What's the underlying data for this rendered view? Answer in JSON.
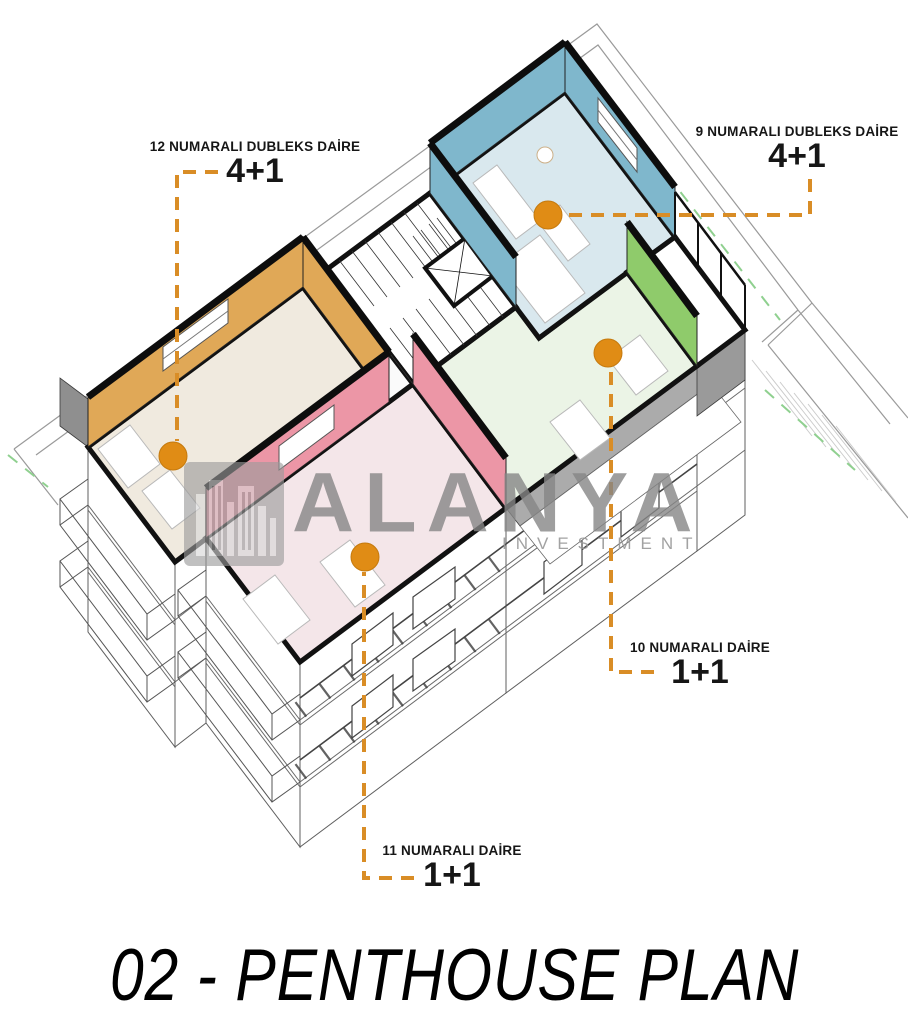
{
  "page": {
    "background": "#ffffff"
  },
  "drawing": {
    "marker_color": "#E08C15",
    "leader_color": "#D98D26",
    "setback_line_color": "#8FD08F",
    "cut_wall_color": "#111111"
  },
  "units": [
    {
      "number": "9",
      "label": "9 NUMARALI DUBLEKS DAİRE",
      "type": "4+1",
      "wall_color": "#7FB7CC",
      "floor_color": "#D9E8EE"
    },
    {
      "number": "10",
      "label": "10 NUMARALI DAİRE",
      "type": "1+1",
      "wall_color": "#8FCB6B",
      "floor_color": "#EBF4E6"
    },
    {
      "number": "11",
      "label": "11 NUMARALI DAİRE",
      "type": "1+1",
      "wall_color": "#EC96A6",
      "floor_color": "#F4E6E9"
    },
    {
      "number": "12",
      "label": "12 NUMARALI DUBLEKS DAİRE",
      "type": "4+1",
      "wall_color": "#E0A857",
      "floor_color": "#F0EADF"
    }
  ],
  "watermark": {
    "brand": "ALANYA",
    "subtitle": "INVESTMENT",
    "color": "#8C8C8C"
  },
  "title": {
    "text": "02 - PENTHOUSE PLAN"
  }
}
